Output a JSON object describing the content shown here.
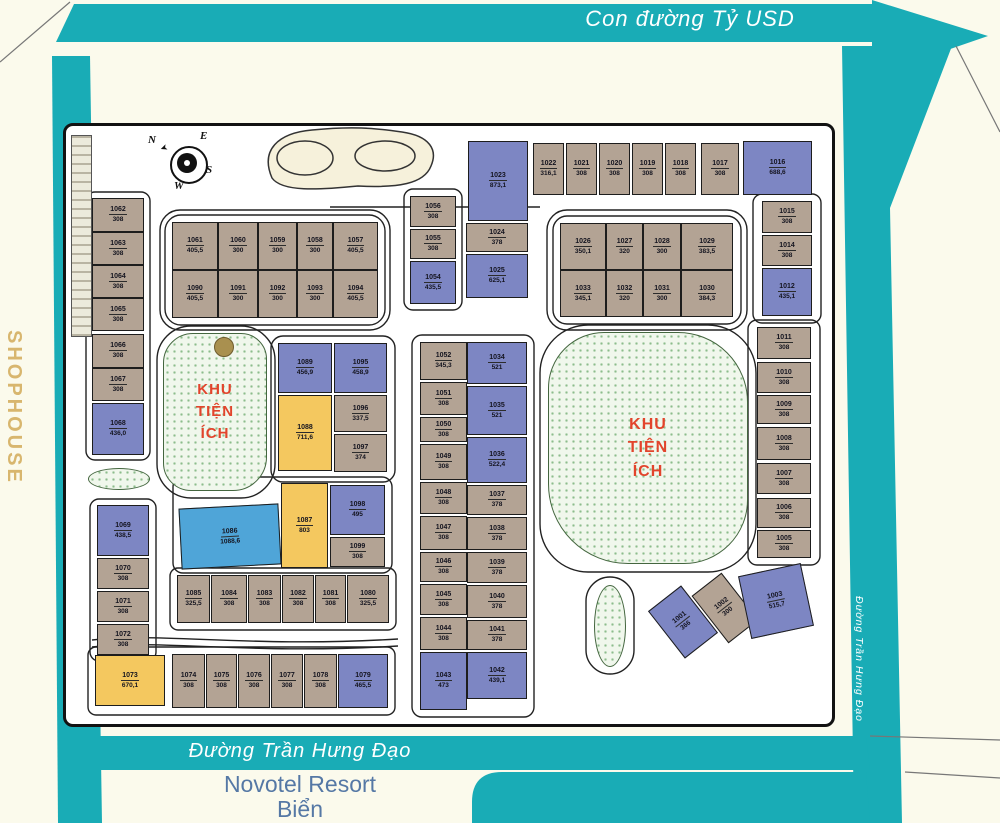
{
  "roads": {
    "top_label": "Con đường Tỷ USD",
    "bottom_label": "Đường Trần Hưng Đạo",
    "right_label": "Đường Trần Hưng Đạo",
    "left_label": "SHOPHOUSE",
    "resort_label": "Novotel Resort",
    "resort_label2": "Biển"
  },
  "parks": {
    "left_lines": [
      "KHU",
      "TIỆN",
      "ÍCH"
    ],
    "right_lines": [
      "KHU",
      "TIỆN",
      "ÍCH"
    ]
  },
  "compass": {
    "n": "N",
    "e": "E",
    "s": "S",
    "w": "W"
  },
  "colors": {
    "road_teal": "#19acb6",
    "lot_tan": "#b3a394",
    "lot_blue": "#7d86c3",
    "lot_yellow": "#f4c85f",
    "lot_cyan": "#4fa5d8",
    "park_text_red": "#e2442c",
    "shophouse_gold": "#d8b66e",
    "novotel_blue": "#5578a5"
  },
  "lots": [
    {
      "id": "1062",
      "a": "308",
      "x": 92,
      "y": 198,
      "w": 52,
      "h": 34,
      "c": "tan"
    },
    {
      "id": "1063",
      "a": "308",
      "x": 92,
      "y": 232,
      "w": 52,
      "h": 33,
      "c": "tan"
    },
    {
      "id": "1064",
      "a": "308",
      "x": 92,
      "y": 265,
      "w": 52,
      "h": 33,
      "c": "tan"
    },
    {
      "id": "1065",
      "a": "308",
      "x": 92,
      "y": 298,
      "w": 52,
      "h": 33,
      "c": "tan"
    },
    {
      "id": "1066",
      "a": "308",
      "x": 92,
      "y": 334,
      "w": 52,
      "h": 34,
      "c": "tan"
    },
    {
      "id": "1067",
      "a": "308",
      "x": 92,
      "y": 368,
      "w": 52,
      "h": 33,
      "c": "tan"
    },
    {
      "id": "1068",
      "a": "436,0",
      "x": 92,
      "y": 403,
      "w": 52,
      "h": 52,
      "c": "blue"
    },
    {
      "id": "1061",
      "a": "405,5",
      "x": 172,
      "y": 222,
      "w": 46,
      "h": 48,
      "c": "tan"
    },
    {
      "id": "1060",
      "a": "300",
      "x": 218,
      "y": 222,
      "w": 40,
      "h": 48,
      "c": "tan"
    },
    {
      "id": "1059",
      "a": "300",
      "x": 258,
      "y": 222,
      "w": 39,
      "h": 48,
      "c": "tan"
    },
    {
      "id": "1058",
      "a": "300",
      "x": 297,
      "y": 222,
      "w": 36,
      "h": 48,
      "c": "tan"
    },
    {
      "id": "1057",
      "a": "405,5",
      "x": 333,
      "y": 222,
      "w": 45,
      "h": 48,
      "c": "tan"
    },
    {
      "id": "1090",
      "a": "405,5",
      "x": 172,
      "y": 270,
      "w": 46,
      "h": 48,
      "c": "tan"
    },
    {
      "id": "1091",
      "a": "300",
      "x": 218,
      "y": 270,
      "w": 40,
      "h": 48,
      "c": "tan"
    },
    {
      "id": "1092",
      "a": "300",
      "x": 258,
      "y": 270,
      "w": 39,
      "h": 48,
      "c": "tan"
    },
    {
      "id": "1093",
      "a": "300",
      "x": 297,
      "y": 270,
      "w": 36,
      "h": 48,
      "c": "tan"
    },
    {
      "id": "1094",
      "a": "405,5",
      "x": 333,
      "y": 270,
      "w": 45,
      "h": 48,
      "c": "tan"
    },
    {
      "id": "1056",
      "a": "308",
      "x": 410,
      "y": 196,
      "w": 46,
      "h": 31,
      "c": "tan"
    },
    {
      "id": "1055",
      "a": "308",
      "x": 410,
      "y": 229,
      "w": 46,
      "h": 30,
      "c": "tan"
    },
    {
      "id": "1054",
      "a": "435,5",
      "x": 410,
      "y": 261,
      "w": 46,
      "h": 43,
      "c": "blue"
    },
    {
      "id": "1023",
      "a": "873,1",
      "x": 468,
      "y": 141,
      "w": 60,
      "h": 80,
      "c": "blue"
    },
    {
      "id": "1024",
      "a": "378",
      "x": 466,
      "y": 223,
      "w": 62,
      "h": 29,
      "c": "tan"
    },
    {
      "id": "1025",
      "a": "625,1",
      "x": 466,
      "y": 254,
      "w": 62,
      "h": 44,
      "c": "blue"
    },
    {
      "id": "1022",
      "a": "316,1",
      "x": 533,
      "y": 143,
      "w": 31,
      "h": 52,
      "c": "tan"
    },
    {
      "id": "1021",
      "a": "308",
      "x": 566,
      "y": 143,
      "w": 31,
      "h": 52,
      "c": "tan"
    },
    {
      "id": "1020",
      "a": "308",
      "x": 599,
      "y": 143,
      "w": 31,
      "h": 52,
      "c": "tan"
    },
    {
      "id": "1019",
      "a": "308",
      "x": 632,
      "y": 143,
      "w": 31,
      "h": 52,
      "c": "tan"
    },
    {
      "id": "1018",
      "a": "308",
      "x": 665,
      "y": 143,
      "w": 31,
      "h": 52,
      "c": "tan"
    },
    {
      "id": "1017",
      "a": "308",
      "x": 701,
      "y": 143,
      "w": 38,
      "h": 52,
      "c": "tan"
    },
    {
      "id": "1016",
      "a": "688,6",
      "x": 743,
      "y": 141,
      "w": 69,
      "h": 54,
      "c": "blue"
    },
    {
      "id": "1026",
      "a": "350,1",
      "x": 560,
      "y": 223,
      "w": 46,
      "h": 47,
      "c": "tan"
    },
    {
      "id": "1027",
      "a": "320",
      "x": 606,
      "y": 223,
      "w": 37,
      "h": 47,
      "c": "tan"
    },
    {
      "id": "1028",
      "a": "300",
      "x": 643,
      "y": 223,
      "w": 38,
      "h": 47,
      "c": "tan"
    },
    {
      "id": "1029",
      "a": "383,5",
      "x": 681,
      "y": 223,
      "w": 52,
      "h": 47,
      "c": "tan"
    },
    {
      "id": "1033",
      "a": "345,1",
      "x": 560,
      "y": 270,
      "w": 46,
      "h": 47,
      "c": "tan"
    },
    {
      "id": "1032",
      "a": "320",
      "x": 606,
      "y": 270,
      "w": 37,
      "h": 47,
      "c": "tan"
    },
    {
      "id": "1031",
      "a": "300",
      "x": 643,
      "y": 270,
      "w": 38,
      "h": 47,
      "c": "tan"
    },
    {
      "id": "1030",
      "a": "384,3",
      "x": 681,
      "y": 270,
      "w": 52,
      "h": 47,
      "c": "tan"
    },
    {
      "id": "1015",
      "a": "308",
      "x": 762,
      "y": 201,
      "w": 50,
      "h": 32,
      "c": "tan"
    },
    {
      "id": "1014",
      "a": "308",
      "x": 762,
      "y": 235,
      "w": 50,
      "h": 31,
      "c": "tan"
    },
    {
      "id": "1012",
      "a": "435,1",
      "x": 762,
      "y": 268,
      "w": 50,
      "h": 48,
      "c": "blue"
    },
    {
      "id": "1011",
      "a": "308",
      "x": 757,
      "y": 327,
      "w": 54,
      "h": 32,
      "c": "tan"
    },
    {
      "id": "1010",
      "a": "308",
      "x": 757,
      "y": 362,
      "w": 54,
      "h": 31,
      "c": "tan"
    },
    {
      "id": "1009",
      "a": "308",
      "x": 757,
      "y": 395,
      "w": 54,
      "h": 29,
      "c": "tan"
    },
    {
      "id": "1008",
      "a": "308",
      "x": 757,
      "y": 427,
      "w": 54,
      "h": 33,
      "c": "tan"
    },
    {
      "id": "1007",
      "a": "308",
      "x": 757,
      "y": 463,
      "w": 54,
      "h": 31,
      "c": "tan"
    },
    {
      "id": "1006",
      "a": "308",
      "x": 757,
      "y": 498,
      "w": 54,
      "h": 30,
      "c": "tan"
    },
    {
      "id": "1005",
      "a": "308",
      "x": 757,
      "y": 530,
      "w": 54,
      "h": 28,
      "c": "tan"
    },
    {
      "id": "1001",
      "a": "366",
      "x": 662,
      "y": 592,
      "w": 42,
      "h": 60,
      "c": "blue",
      "r": -38
    },
    {
      "id": "1002",
      "a": "300",
      "x": 706,
      "y": 578,
      "w": 38,
      "h": 60,
      "c": "tan",
      "r": -38
    },
    {
      "id": "1003",
      "a": "515,7",
      "x": 744,
      "y": 569,
      "w": 64,
      "h": 64,
      "c": "blue",
      "r": -12
    },
    {
      "id": "1089",
      "a": "456,9",
      "x": 278,
      "y": 343,
      "w": 54,
      "h": 50,
      "c": "blue"
    },
    {
      "id": "1095",
      "a": "458,9",
      "x": 334,
      "y": 343,
      "w": 53,
      "h": 50,
      "c": "blue"
    },
    {
      "id": "1088",
      "a": "711,6",
      "x": 278,
      "y": 395,
      "w": 54,
      "h": 76,
      "c": "yellow"
    },
    {
      "id": "1096",
      "a": "337,5",
      "x": 334,
      "y": 395,
      "w": 53,
      "h": 37,
      "c": "tan"
    },
    {
      "id": "1097",
      "a": "374",
      "x": 334,
      "y": 434,
      "w": 53,
      "h": 38,
      "c": "tan"
    },
    {
      "id": "1086",
      "a": "1088,6",
      "x": 180,
      "y": 506,
      "w": 100,
      "h": 61,
      "c": "cyan",
      "r": -3
    },
    {
      "id": "1087",
      "a": "803",
      "x": 281,
      "y": 483,
      "w": 47,
      "h": 85,
      "c": "yellow"
    },
    {
      "id": "1098",
      "a": "495",
      "x": 330,
      "y": 485,
      "w": 55,
      "h": 50,
      "c": "blue"
    },
    {
      "id": "1099",
      "a": "308",
      "x": 330,
      "y": 537,
      "w": 55,
      "h": 30,
      "c": "tan"
    },
    {
      "id": "1085",
      "a": "325,5",
      "x": 177,
      "y": 575,
      "w": 33,
      "h": 48,
      "c": "tan"
    },
    {
      "id": "1084",
      "a": "308",
      "x": 211,
      "y": 575,
      "w": 36,
      "h": 48,
      "c": "tan"
    },
    {
      "id": "1083",
      "a": "308",
      "x": 248,
      "y": 575,
      "w": 33,
      "h": 48,
      "c": "tan"
    },
    {
      "id": "1082",
      "a": "308",
      "x": 282,
      "y": 575,
      "w": 32,
      "h": 48,
      "c": "tan"
    },
    {
      "id": "1081",
      "a": "308",
      "x": 315,
      "y": 575,
      "w": 31,
      "h": 48,
      "c": "tan"
    },
    {
      "id": "1080",
      "a": "325,5",
      "x": 347,
      "y": 575,
      "w": 42,
      "h": 48,
      "c": "tan"
    },
    {
      "id": "1073",
      "a": "670,1",
      "x": 95,
      "y": 655,
      "w": 70,
      "h": 51,
      "c": "yellow"
    },
    {
      "id": "1074",
      "a": "308",
      "x": 172,
      "y": 654,
      "w": 33,
      "h": 54,
      "c": "tan"
    },
    {
      "id": "1075",
      "a": "308",
      "x": 206,
      "y": 654,
      "w": 31,
      "h": 54,
      "c": "tan"
    },
    {
      "id": "1076",
      "a": "308",
      "x": 238,
      "y": 654,
      "w": 32,
      "h": 54,
      "c": "tan"
    },
    {
      "id": "1077",
      "a": "308",
      "x": 271,
      "y": 654,
      "w": 32,
      "h": 54,
      "c": "tan"
    },
    {
      "id": "1078",
      "a": "308",
      "x": 304,
      "y": 654,
      "w": 33,
      "h": 54,
      "c": "tan"
    },
    {
      "id": "1079",
      "a": "465,5",
      "x": 338,
      "y": 654,
      "w": 50,
      "h": 54,
      "c": "blue"
    },
    {
      "id": "1069",
      "a": "438,5",
      "x": 97,
      "y": 505,
      "w": 52,
      "h": 51,
      "c": "blue"
    },
    {
      "id": "1070",
      "a": "308",
      "x": 97,
      "y": 558,
      "w": 52,
      "h": 31,
      "c": "tan"
    },
    {
      "id": "1071",
      "a": "308",
      "x": 97,
      "y": 591,
      "w": 52,
      "h": 31,
      "c": "tan"
    },
    {
      "id": "1072",
      "a": "308",
      "x": 97,
      "y": 624,
      "w": 52,
      "h": 31,
      "c": "tan"
    },
    {
      "id": "1052",
      "a": "345,3",
      "x": 420,
      "y": 342,
      "w": 47,
      "h": 38,
      "c": "tan"
    },
    {
      "id": "1051",
      "a": "308",
      "x": 420,
      "y": 382,
      "w": 47,
      "h": 33,
      "c": "tan"
    },
    {
      "id": "1050",
      "a": "308",
      "x": 420,
      "y": 417,
      "w": 47,
      "h": 25,
      "c": "tan"
    },
    {
      "id": "1049",
      "a": "308",
      "x": 420,
      "y": 444,
      "w": 47,
      "h": 36,
      "c": "tan"
    },
    {
      "id": "1048",
      "a": "308",
      "x": 420,
      "y": 482,
      "w": 47,
      "h": 32,
      "c": "tan"
    },
    {
      "id": "1047",
      "a": "308",
      "x": 420,
      "y": 516,
      "w": 47,
      "h": 34,
      "c": "tan"
    },
    {
      "id": "1046",
      "a": "308",
      "x": 420,
      "y": 552,
      "w": 47,
      "h": 30,
      "c": "tan"
    },
    {
      "id": "1045",
      "a": "308",
      "x": 420,
      "y": 584,
      "w": 47,
      "h": 31,
      "c": "tan"
    },
    {
      "id": "1044",
      "a": "308",
      "x": 420,
      "y": 617,
      "w": 47,
      "h": 33,
      "c": "tan"
    },
    {
      "id": "1043",
      "a": "473",
      "x": 420,
      "y": 652,
      "w": 47,
      "h": 58,
      "c": "blue"
    },
    {
      "id": "1034",
      "a": "521",
      "x": 467,
      "y": 342,
      "w": 60,
      "h": 42,
      "c": "blue"
    },
    {
      "id": "1035",
      "a": "521",
      "x": 467,
      "y": 386,
      "w": 60,
      "h": 49,
      "c": "blue"
    },
    {
      "id": "1036",
      "a": "522,4",
      "x": 467,
      "y": 437,
      "w": 60,
      "h": 46,
      "c": "blue"
    },
    {
      "id": "1037",
      "a": "378",
      "x": 467,
      "y": 485,
      "w": 60,
      "h": 30,
      "c": "tan"
    },
    {
      "id": "1038",
      "a": "378",
      "x": 467,
      "y": 517,
      "w": 60,
      "h": 33,
      "c": "tan"
    },
    {
      "id": "1039",
      "a": "378",
      "x": 467,
      "y": 552,
      "w": 60,
      "h": 31,
      "c": "tan"
    },
    {
      "id": "1040",
      "a": "378",
      "x": 467,
      "y": 585,
      "w": 60,
      "h": 33,
      "c": "tan"
    },
    {
      "id": "1041",
      "a": "378",
      "x": 467,
      "y": 620,
      "w": 60,
      "h": 30,
      "c": "tan"
    },
    {
      "id": "1042",
      "a": "439,1",
      "x": 467,
      "y": 652,
      "w": 60,
      "h": 47,
      "c": "blue"
    }
  ]
}
